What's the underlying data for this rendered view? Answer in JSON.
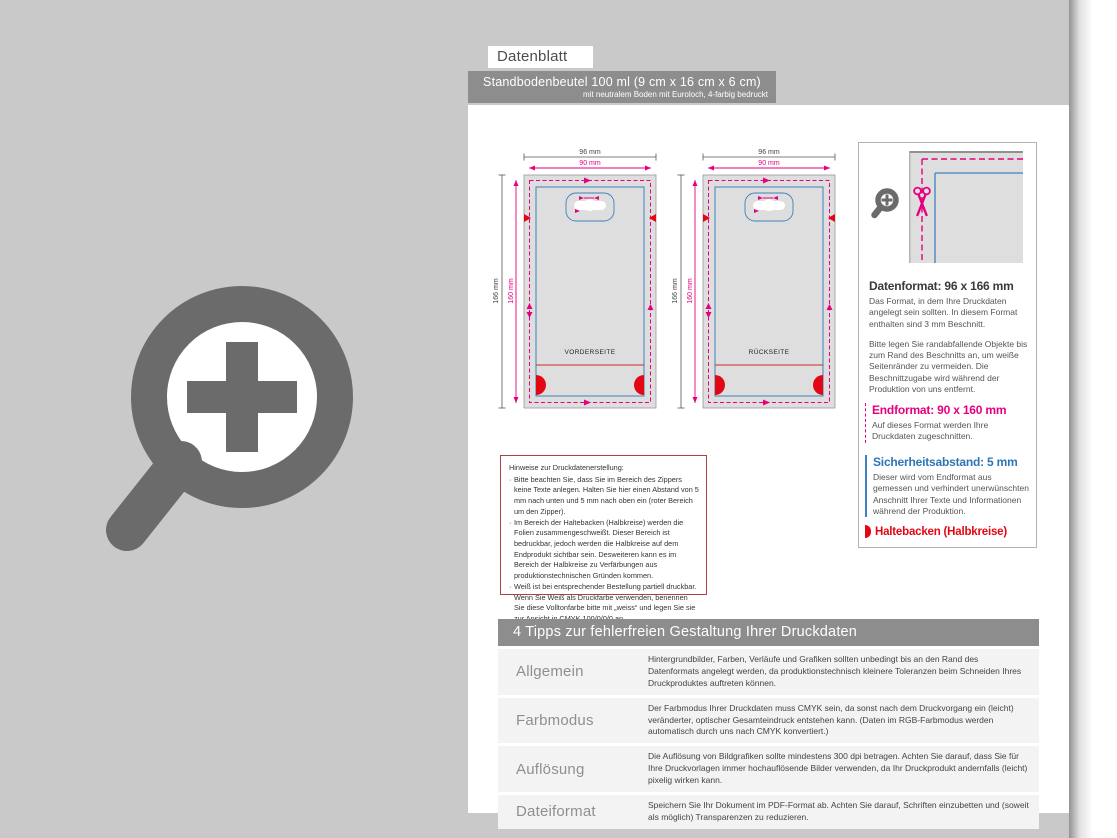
{
  "page": {
    "title": "Datenblatt",
    "product_line1": "Standbodenbeutel 100 ml (9 cm x 16 cm x 6 cm)",
    "product_line2": "mit neutralem Boden mit Euroloch, 4-farbig bedruckt"
  },
  "diagram": {
    "front_label": "VORDERSEITE",
    "back_label": "RÜCKSEITE",
    "dims": {
      "outer_width": "96 mm",
      "inner_width": "90 mm",
      "outer_height": "166 mm",
      "inner_height": "160 mm"
    }
  },
  "info_panel": {
    "datenformat_title": "Datenformat: 96 x 166 mm",
    "datenformat_p1": "Das Format, in dem Ihre Druckdaten angelegt sein sollten. In diesem Format enthalten sind 3 mm Beschnitt.",
    "datenformat_p2": "Bitte legen Sie randabfallende Objekte bis zum Rand des Beschnitts an, um weiße Seitenränder zu vermeiden. Die Beschnittzugabe wird während der Produktion von uns entfernt.",
    "endformat_title": "Endformat: 90 x 160 mm",
    "endformat_p": "Auf dieses Format werden Ihre Druckdaten zugeschnitten.",
    "sicherheit_title": "Sicherheitsabstand: 5 mm",
    "sicherheit_p": "Dieser wird vom Endformat aus gemessen und verhindert unerwünschten Anschnitt Ihrer Texte und Informationen während der Produktion.",
    "haltebacken_label": "Haltebacken (Halbkreise)"
  },
  "hinweise": {
    "title": "Hinweise zur Druckdatenerstellung:",
    "items": [
      "Bitte beachten Sie, dass Sie im Bereich des Zippers keine Texte anlegen. Halten Sie hier einen Abstand von 5 mm nach unten und 5 mm nach oben ein (roter Bereich um den Zipper).",
      "Im Bereich der Haltebacken (Halbkreise) werden die Folien zusammengeschweißt. Dieser Bereich ist bedruckbar, jedoch werden die Halbkreise auf dem Endprodukt sichtbar sein. Desweiteren kann es im Bereich der Halbkreise zu Verfärbungen aus produktionstechnischen Gründen kommen.",
      "Weiß ist bei entsprechender Bestellung partiell druckbar. Wenn Sie Weiß als Druckfarbe verwenden, benennen Sie diese Volltonfarbe bitte mit „weiss“ und legen Sie sie zur Ansicht in CMYK 100/0/0/0 an."
    ]
  },
  "tips": {
    "header": "4 Tipps zur fehlerfreien Gestaltung Ihrer Druckdaten",
    "rows": [
      {
        "label": "Allgemein",
        "text": "Hintergrundbilder, Farben, Verläufe und Grafiken sollten unbedingt bis an den Rand des Datenformats angelegt werden, da produktionstechnisch kleinere Toleranzen beim Schneiden Ihres Druckproduktes auftreten können."
      },
      {
        "label": "Farbmodus",
        "text": "Der Farbmodus Ihrer Druckdaten muss CMYK sein, da sonst nach dem Druckvorgang ein (leicht) veränderter, optischer Gesamteindruck entstehen kann. (Daten im RGB-Farbmodus werden automatisch durch uns nach CMYK konvertiert.)"
      },
      {
        "label": "Auflösung",
        "text": "Die Auflösung von Bildgrafiken sollte mindestens 300 dpi betragen. Achten Sie darauf, dass Sie für Ihre Druckvorlagen immer hochauflösende Bilder verwenden, da Ihr Druckprodukt andernfalls (leicht) pixelig wirken kann."
      },
      {
        "label": "Dateiformat",
        "text": "Speichern Sie Ihr Dokument im PDF-Format ab. Achten Sie darauf, Schriften einzubetten und (soweit als möglich) Transparenzen zu reduzieren."
      }
    ]
  },
  "colors": {
    "datenformat_gray_fill": "#dedede",
    "endformat_magenta": "#e6007e",
    "sicherheit_blue": "#4080c0",
    "haltebacken_red": "#e30613",
    "header_bar_gray": "#8d8d8d",
    "background_gray": "#c9c9c9"
  }
}
